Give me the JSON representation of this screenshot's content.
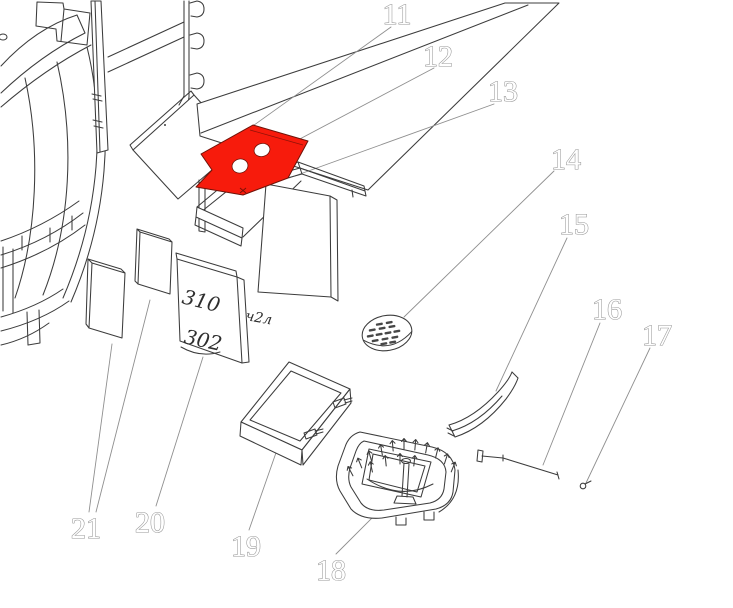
{
  "figure": {
    "kind": "exploded-parts-diagram",
    "background": "#ffffff",
    "line_color": "#3c3c3c",
    "leader_color": "#8f8f8f",
    "highlight_color": "#f71b0c",
    "callout_fill": "#ffffff",
    "callout_outline": "#979797"
  },
  "callouts": [
    {
      "num": "11"
    },
    {
      "num": "12"
    },
    {
      "num": "13"
    },
    {
      "num": "14"
    },
    {
      "num": "15"
    },
    {
      "num": "16"
    },
    {
      "num": "17"
    },
    {
      "num": "18"
    },
    {
      "num": "19"
    },
    {
      "num": "20"
    },
    {
      "num": "21"
    }
  ],
  "markings": {
    "panel_top": "310",
    "panel_bottom": "302",
    "panel_side": "ч2л"
  }
}
